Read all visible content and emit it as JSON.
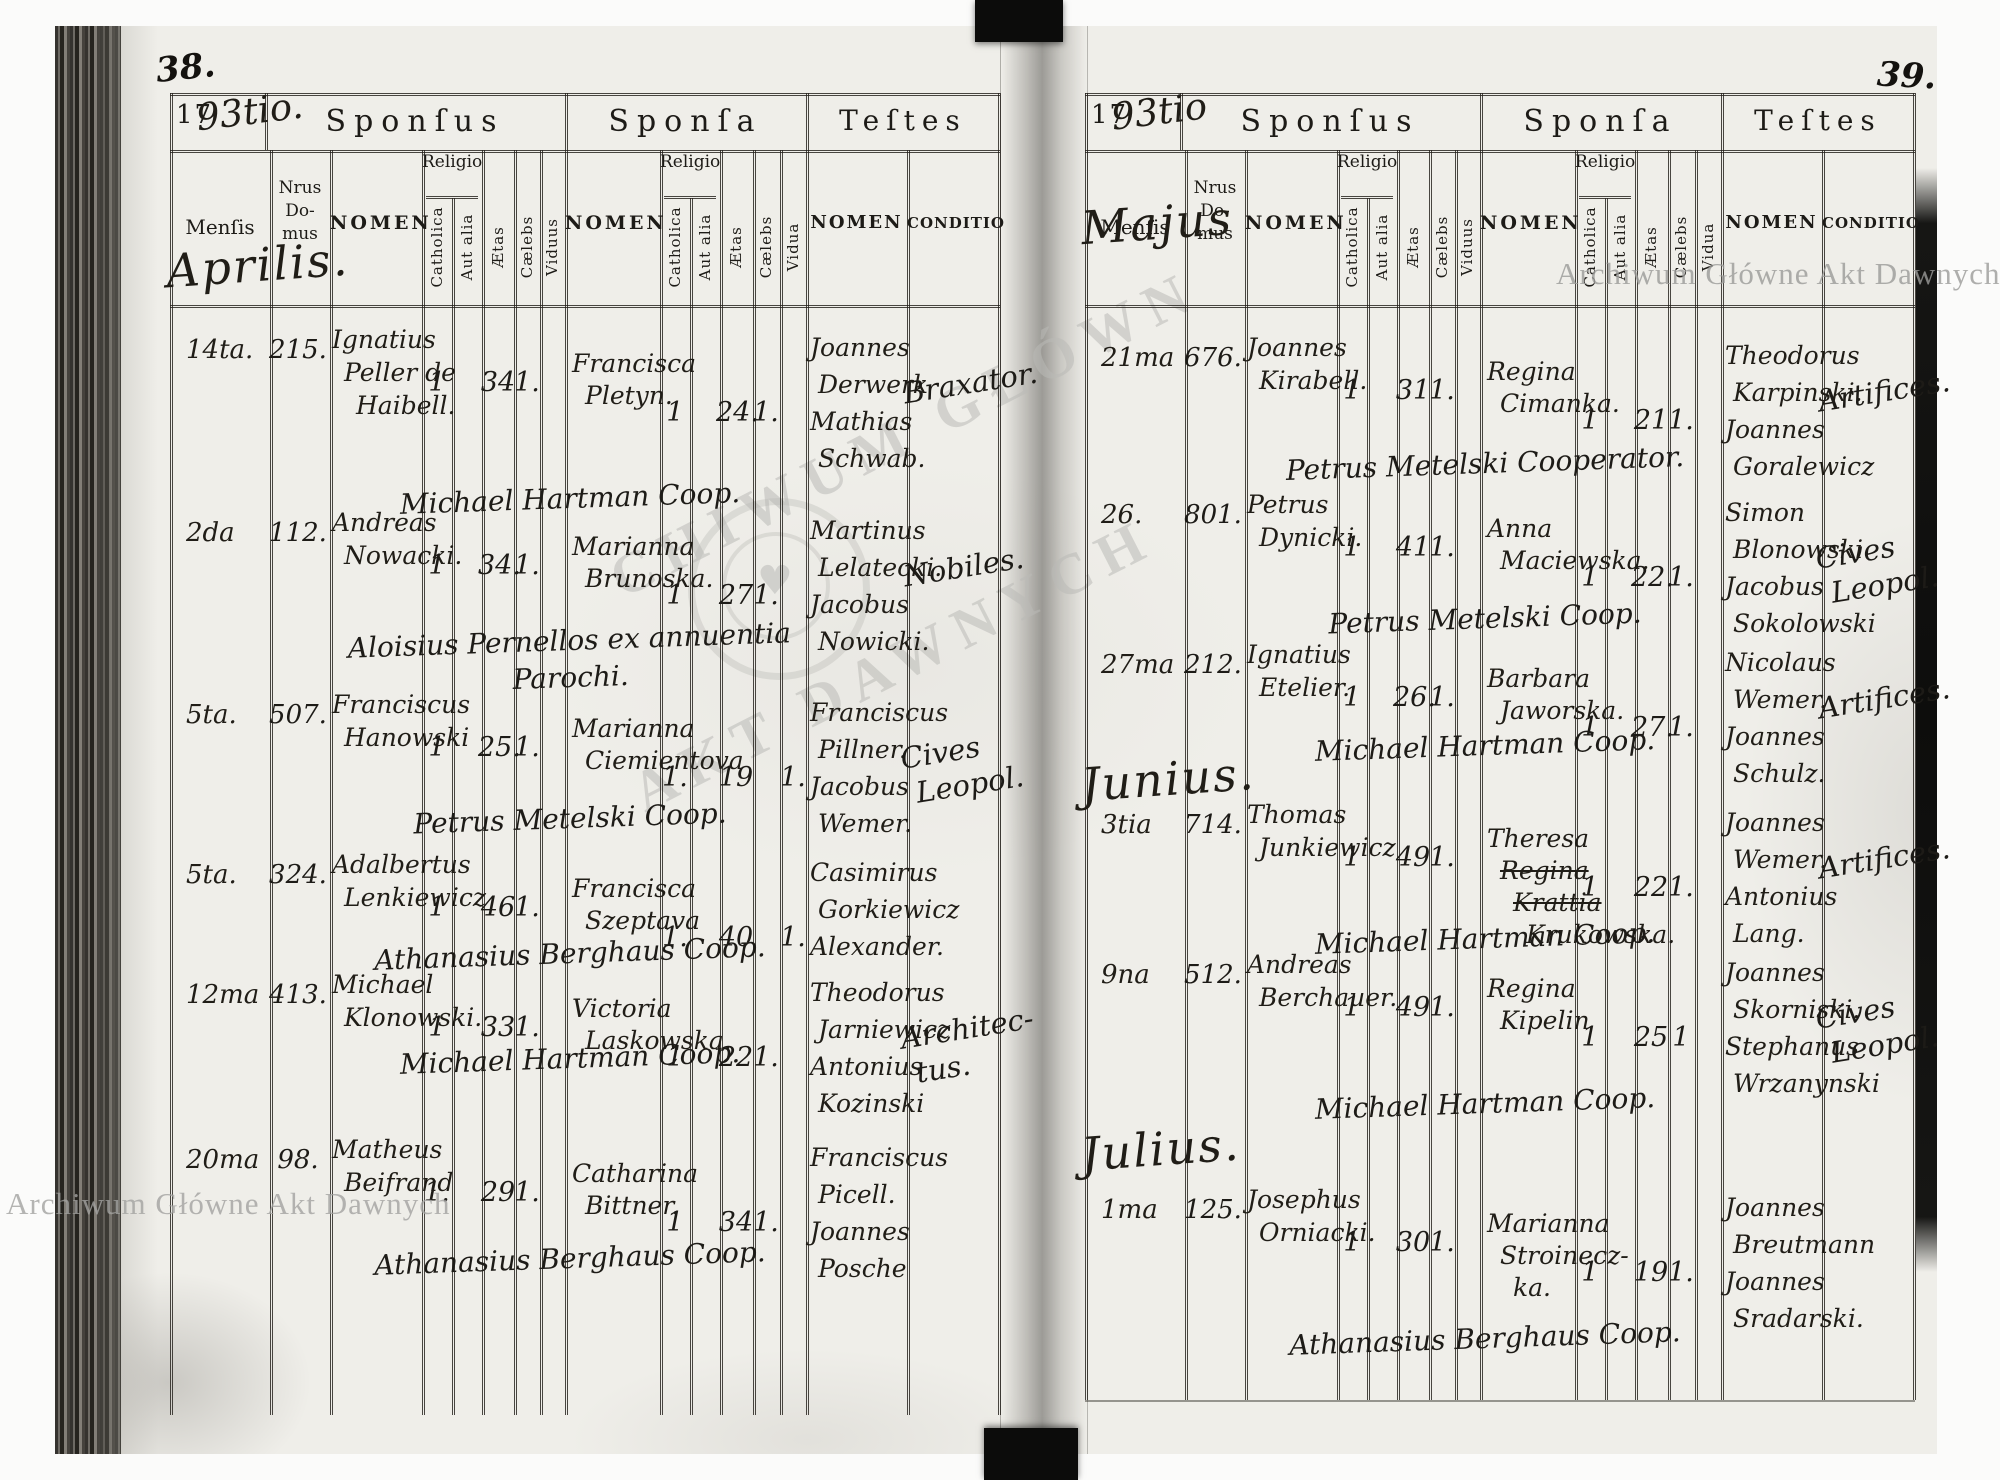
{
  "watermark": {
    "archive_name": "Archiwum Główne Akt Dawnych",
    "center_line1": "CHIWUM GŁÓWN",
    "center_line2": "AKT DAWNYCH",
    "suit_glyph": "♥"
  },
  "headers": {
    "year_printed": "17",
    "sections": {
      "sponsus": "Sponſus",
      "sponsa": "Sponſa",
      "testes": "Teſtes"
    },
    "columns": {
      "mensis": "Menſis",
      "nrus_domus": [
        "Nrus",
        "Do-",
        "mus"
      ],
      "nomen": "NOMEN",
      "religio": "Religio",
      "catholica": "Catholica",
      "aut_alia": "Aut alia",
      "aetas": "Ætas",
      "caelebs": "Cælebs",
      "viduus": "Viduus",
      "vidua": "Vidua",
      "conditio": "CONDITIO"
    }
  },
  "pages": [
    {
      "page_number": "38.",
      "year_hand": "93tio.",
      "entries": [
        {
          "month_before": "Aprilis.",
          "date": "14ta.",
          "house": "215.",
          "sponsus_name": [
            "Ignatius",
            "Peller de",
            "Haibell."
          ],
          "sponsus": {
            "catholica": "1",
            "aut_alia": "",
            "aetas": "34",
            "caelebs": "1.",
            "viduus": ""
          },
          "sponsa_name": [
            "Francisca",
            "Pletyn."
          ],
          "sponsa": {
            "catholica": "1",
            "aut_alia": "",
            "aetas": "24.",
            "caelebs": "1.",
            "vidua": ""
          },
          "testes": [
            "Joannes",
            "Derwerk",
            "Mathias",
            "Schwab."
          ],
          "conditio": [
            "Braxator."
          ],
          "note": [
            "Michael Hartman Coop."
          ]
        },
        {
          "date": "2da",
          "house": "112.",
          "sponsus_name": [
            "Andreas",
            "Nowacki."
          ],
          "sponsus": {
            "catholica": "1",
            "aut_alia": "",
            "aetas": "34.",
            "caelebs": "1.",
            "viduus": ""
          },
          "sponsa_name": [
            "Marianna",
            "Brunoska."
          ],
          "sponsa": {
            "catholica": "1",
            "aut_alia": "",
            "aetas": "27",
            "caelebs": "1.",
            "vidua": ""
          },
          "testes": [
            "Martinus",
            "Lelatecki.",
            "Jacobus",
            "Nowicki."
          ],
          "conditio": [
            "Nobiles."
          ],
          "note": [
            "Aloisius Pernellos ex annuentia",
            "Parochi."
          ]
        },
        {
          "date": "5ta.",
          "house": "507.",
          "sponsus_name": [
            "Franciscus",
            "Hanowski"
          ],
          "sponsus": {
            "catholica": "1",
            "aut_alia": "",
            "aetas": "25.",
            "caelebs": "1.",
            "viduus": ""
          },
          "sponsa_name": [
            "Marianna",
            "Ciemientova"
          ],
          "sponsa": {
            "catholica": "1.",
            "aut_alia": "",
            "aetas": "19",
            "caelebs": "",
            "vidua": "1."
          },
          "testes": [
            "Franciscus",
            "Pillner.",
            "Jacobus",
            "Wemer."
          ],
          "conditio": [
            "Cives",
            "Leopol."
          ],
          "note": [
            "Petrus Metelski Coop."
          ]
        },
        {
          "date": "5ta.",
          "house": "324.",
          "sponsus_name": [
            "Adalbertus",
            "Lenkiewicz"
          ],
          "sponsus": {
            "catholica": "1",
            "aut_alia": "",
            "aetas": "46",
            "caelebs": "1.",
            "viduus": ""
          },
          "sponsa_name": [
            "Francisca",
            "Szeptava"
          ],
          "sponsa": {
            "catholica": "1.",
            "aut_alia": "",
            "aetas": "40",
            "caelebs": "",
            "vidua": "1."
          },
          "testes": [
            "Casimirus",
            "Gorkiewicz",
            "Alexander."
          ],
          "conditio": [],
          "note": [
            "Athanasius Berghaus Coop."
          ]
        },
        {
          "date": "12ma",
          "house": "413.",
          "sponsus_name": [
            "Michael",
            "Klonowski."
          ],
          "sponsus": {
            "catholica": "1",
            "aut_alia": "",
            "aetas": "33",
            "caelebs": "1.",
            "viduus": ""
          },
          "sponsa_name": [
            "Victoria",
            "Laskowska."
          ],
          "sponsa": {
            "catholica": "1",
            "aut_alia": "",
            "aetas": "22",
            "caelebs": "1.",
            "vidua": ""
          },
          "testes": [
            "Theodorus",
            "Jarniewicz",
            "Antonius",
            "Kozinski"
          ],
          "conditio": [
            "Architec-",
            "tus."
          ],
          "note": [
            "Michael Hartman Coop."
          ]
        },
        {
          "date": "20ma",
          "house": "98.",
          "sponsus_name": [
            "Matheus",
            "Beifrand"
          ],
          "sponsus": {
            "catholica": "1.",
            "aut_alia": "",
            "aetas": "29",
            "caelebs": "1.",
            "viduus": ""
          },
          "sponsa_name": [
            "Catharina",
            "Bittner."
          ],
          "sponsa": {
            "catholica": "1",
            "aut_alia": "",
            "aetas": "34",
            "caelebs": "1.",
            "vidua": ""
          },
          "testes": [
            "Franciscus",
            "Picell.",
            "Joannes",
            "Posche"
          ],
          "conditio": [],
          "note": [
            "Athanasius Berghaus Coop."
          ]
        }
      ]
    },
    {
      "page_number": "39.",
      "year_hand": "93tio",
      "entries": [
        {
          "month_before": "Majus",
          "date": "21ma",
          "house": "676.",
          "sponsus_name": [
            "Joannes",
            "Kirabell."
          ],
          "sponsus": {
            "catholica": "1",
            "aut_alia": "",
            "aetas": "31",
            "caelebs": "1.",
            "viduus": ""
          },
          "sponsa_name": [
            "Regina",
            "Cimanka."
          ],
          "sponsa": {
            "catholica": "1",
            "aut_alia": "",
            "aetas": "21",
            "caelebs": "1.",
            "vidua": ""
          },
          "testes": [
            "Theodorus",
            "Karpinski.",
            "Joannes",
            "Goralewicz"
          ],
          "conditio": [
            "Artifices."
          ],
          "note": [
            "Petrus Metelski Cooperator."
          ]
        },
        {
          "date": "26.",
          "house": "801.",
          "sponsus_name": [
            "Petrus",
            "Dynicki."
          ],
          "sponsus": {
            "catholica": "1",
            "aut_alia": "",
            "aetas": "41",
            "caelebs": "1.",
            "viduus": ""
          },
          "sponsa_name": [
            "Anna",
            "Maciewska."
          ],
          "sponsa": {
            "catholica": "1",
            "aut_alia": "",
            "aetas": "22.",
            "caelebs": "1.",
            "vidua": ""
          },
          "testes": [
            "Simon",
            "Blonowski",
            "Jacobus",
            "Sokolowski"
          ],
          "conditio": [
            "Cives",
            "Leopol."
          ],
          "note": [
            "Petrus Metelski Coop."
          ]
        },
        {
          "date": "27ma",
          "house": "212.",
          "sponsus_name": [
            "Ignatius",
            "Etelier."
          ],
          "sponsus": {
            "catholica": "1",
            "aut_alia": "",
            "aetas": "26.",
            "caelebs": "1.",
            "viduus": ""
          },
          "sponsa_name": [
            "Barbara",
            "Jaworska."
          ],
          "sponsa": {
            "catholica": "1",
            "aut_alia": "",
            "aetas": "27.",
            "caelebs": "1.",
            "vidua": ""
          },
          "testes": [
            "Nicolaus",
            "Wemer.",
            "Joannes",
            "Schulz."
          ],
          "conditio": [
            "Artifices."
          ],
          "note": [
            "Michael Hartman Coop."
          ]
        },
        {
          "month_before": "Junius.",
          "date": "3tia",
          "house": "714.",
          "sponsus_name": [
            "Thomas",
            "Junkiewicz"
          ],
          "sponsus": {
            "catholica": "1",
            "aut_alia": "",
            "aetas": "49",
            "caelebs": "1.",
            "viduus": ""
          },
          "sponsa_name": [
            "Theresa",
            "~Regina~",
            "~Krattia~",
            "Krukowska."
          ],
          "sponsa": {
            "catholica": "1",
            "aut_alia": "",
            "aetas": "22",
            "caelebs": "1.",
            "vidua": ""
          },
          "testes": [
            "Joannes",
            "Wemer.",
            "Antonius",
            "Lang."
          ],
          "conditio": [
            "Artifices."
          ],
          "note": [
            "Michael Hartman Coop."
          ]
        },
        {
          "date": "9na",
          "house": "512.",
          "sponsus_name": [
            "Andreas",
            "Berchauer."
          ],
          "sponsus": {
            "catholica": "1",
            "aut_alia": "",
            "aetas": "49",
            "caelebs": "1.",
            "viduus": ""
          },
          "sponsa_name": [
            "Regina",
            "Kipelin"
          ],
          "sponsa": {
            "catholica": "1",
            "aut_alia": "",
            "aetas": "25",
            "caelebs": "1",
            "vidua": ""
          },
          "testes": [
            "Joannes",
            "Skorniski.",
            "Stephanus",
            "Wrzanynski"
          ],
          "conditio": [
            "Cives",
            "Leopol."
          ],
          "note": [
            "Michael Hartman Coop."
          ]
        },
        {
          "month_before": "Julius.",
          "date": "1ma",
          "house": "125.",
          "sponsus_name": [
            "Josephus",
            "Orniacki."
          ],
          "sponsus": {
            "catholica": "1",
            "aut_alia": "",
            "aetas": "30",
            "caelebs": "1.",
            "viduus": ""
          },
          "sponsa_name": [
            "Marianna",
            "Stroinecz-",
            "ka."
          ],
          "sponsa": {
            "catholica": "1",
            "aut_alia": "",
            "aetas": "19",
            "caelebs": "1.",
            "vidua": ""
          },
          "testes": [
            "Joannes",
            "Breutmann",
            "Joannes",
            "Sradarski."
          ],
          "conditio": [],
          "note": [
            "Athanasius Berghaus Coop."
          ]
        }
      ]
    }
  ]
}
